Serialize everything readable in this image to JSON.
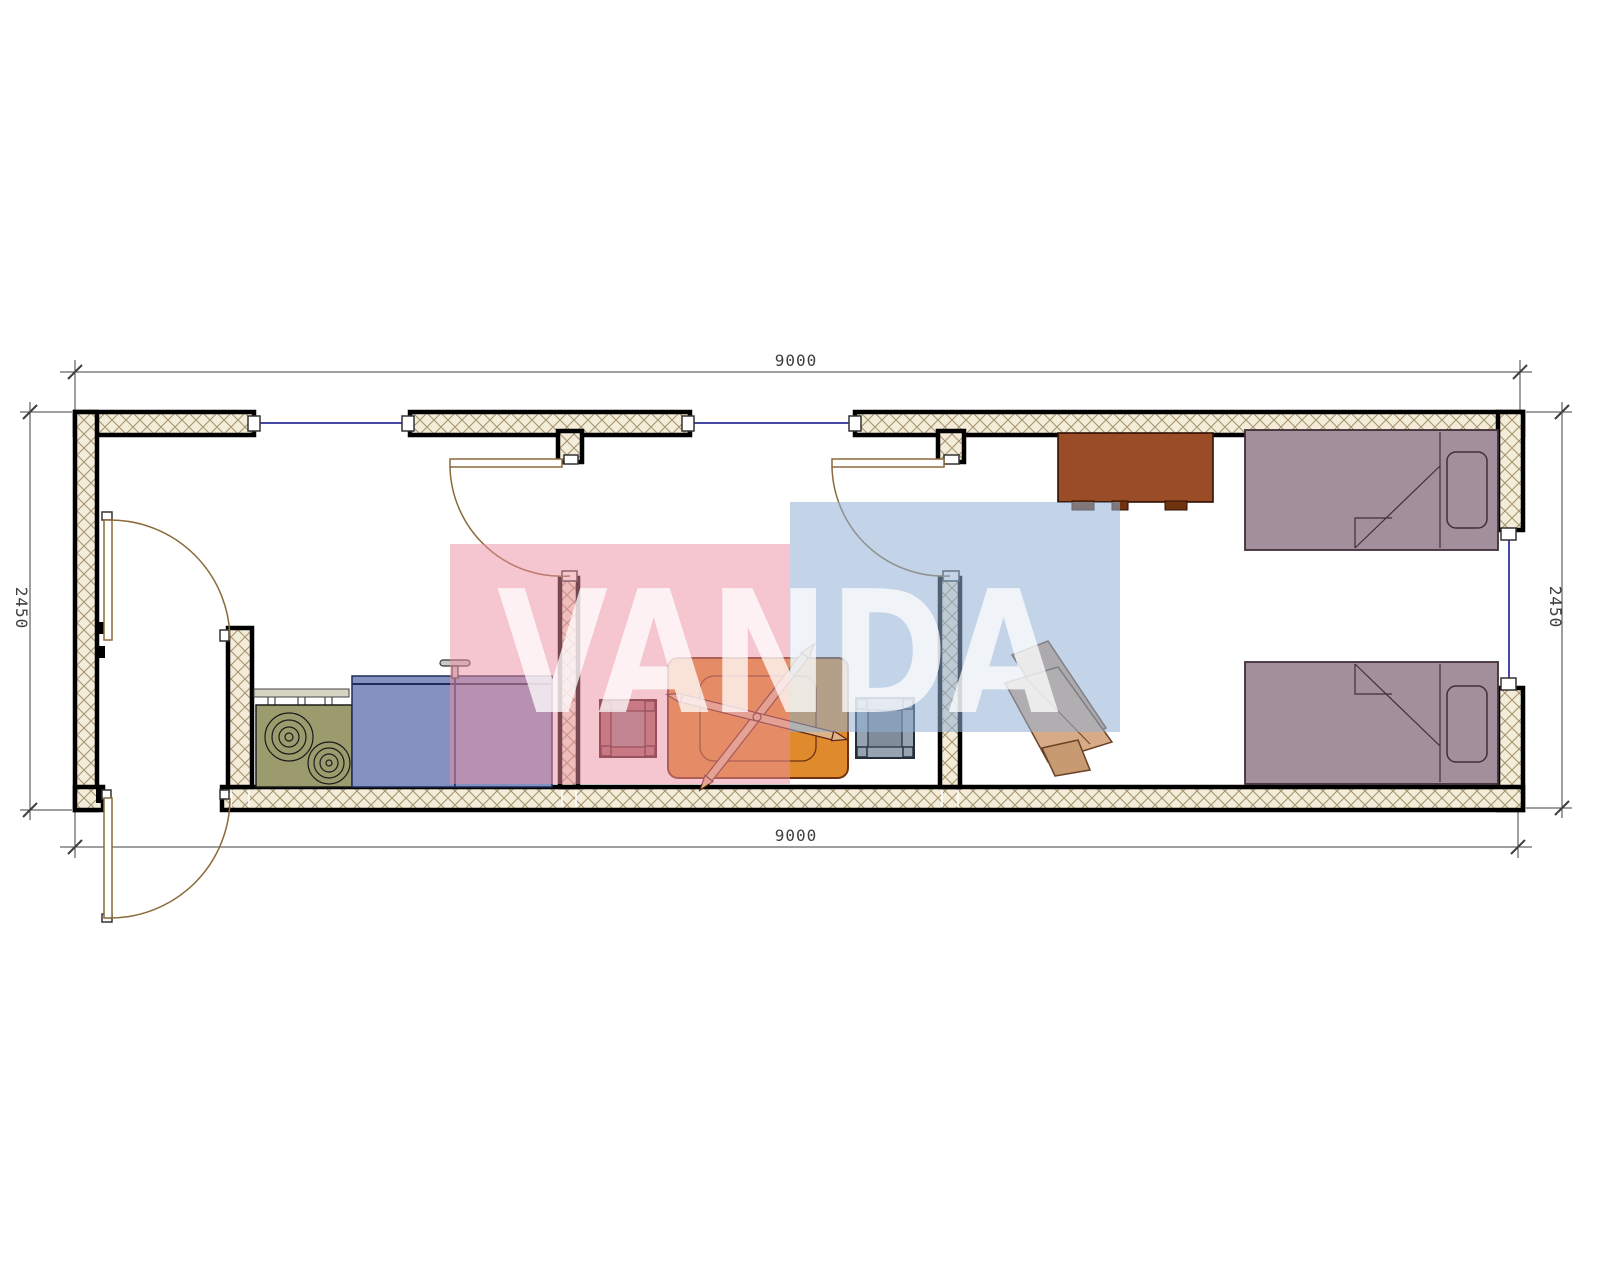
{
  "dimensions": {
    "top": "9000",
    "bottom": "9000",
    "left": "2450",
    "right": "2450"
  },
  "watermark": {
    "text": "VANDA",
    "pink_block_color": "#eb8da0",
    "blue_block_color": "#91b0d6",
    "text_color": "#ffffff"
  },
  "drawing": {
    "wall_fill": "#f3ecd9",
    "wall_hatch_color": "#a79470",
    "wall_outline_color": "#000000",
    "window_color": "#4747a5",
    "door_color": "#8a6a3a",
    "dimension_color": "#3f3f3f"
  },
  "furniture": {
    "stove_color": "#9c9b6e",
    "vent_color": "#d5d4c0",
    "counter_color": "#8492c2",
    "counter_edge_color": "#1f2c55",
    "stool_left_color": "#a56569",
    "stool_left_outline": "#451418",
    "stool_right_color": "#96a4b2",
    "stool_right_outline": "#242e3a",
    "table_color": "#de8a2d",
    "table_outline": "#6f3210",
    "table_stick_color": "#dcb488",
    "wardrobe_color": "#9a4c27",
    "wardrobe_handle_color": "#6f340f",
    "bed_color": "#a28f9b",
    "bed_outline_color": "#3f2f39",
    "chair_color": "#cfa27f",
    "chair_outline": "#6b4226",
    "faucet_color": "#c9c9c9"
  }
}
